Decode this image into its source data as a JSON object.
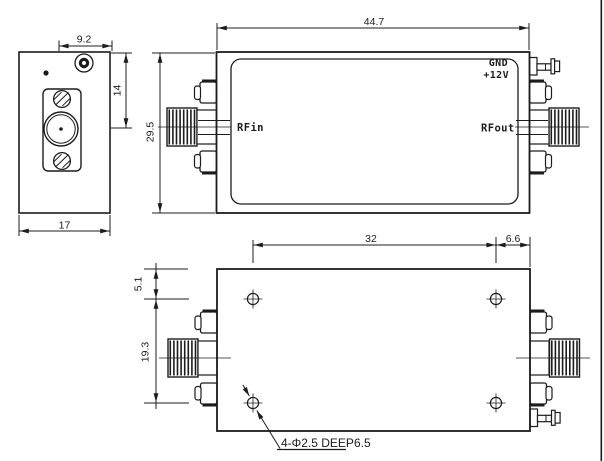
{
  "colors": {
    "ink": "#1c1c1e",
    "paper": "#ffffff"
  },
  "end_view": {
    "dim_top_width": "9.2",
    "dim_side_height": "14",
    "dim_bottom_width": "17"
  },
  "front_view": {
    "dim_length": "44.7",
    "dim_height": "29.5",
    "rf_input_label": "RFin",
    "rf_output_label": "RFout",
    "ground_label": "GND",
    "power_label": "+12V"
  },
  "bottom_view": {
    "dim_hole_span": "32",
    "dim_hole_to_edge": "6.6",
    "dim_hole_to_top": "5.1",
    "dim_hole_pitch": "19.3",
    "mounting_hole_note": "4-Φ2.5 DEEP6.5"
  }
}
